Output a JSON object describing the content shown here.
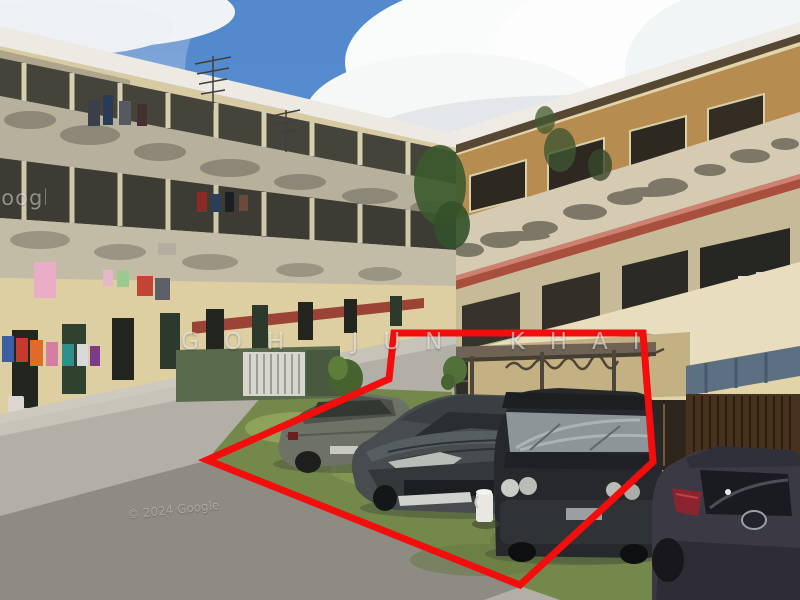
{
  "image": {
    "description": "Street-level photo of aging three-storey walk-up apartment blocks; four cars parked on a grass verge are outlined by a thick red polygon annotation"
  },
  "watermarks": {
    "center": "GOH JUN KHAI",
    "copyright": "© 2024 Google",
    "side": "Google"
  },
  "annotation": {
    "shape": "polygon",
    "label": "outlined-parking-area",
    "color": "#f30d0d",
    "stroke_width": 7,
    "points": "394,333 643,333 653,462 520,585 207,460 389,379"
  },
  "palette": {
    "annotation_red": "#f30d0d",
    "sky_blue": "#4e86cb",
    "cloud_white": "#fbfcfb",
    "building_cream": "#e2d4a9",
    "building_orange_band": "#b78c50",
    "awning_red": "#a8503d",
    "awning_blue": "#5d7082",
    "roof_eave_brown": "#564732",
    "grass_green": "#75884b",
    "road_gray": "#b2afa6",
    "shadow_gray": "#8e8b83"
  }
}
